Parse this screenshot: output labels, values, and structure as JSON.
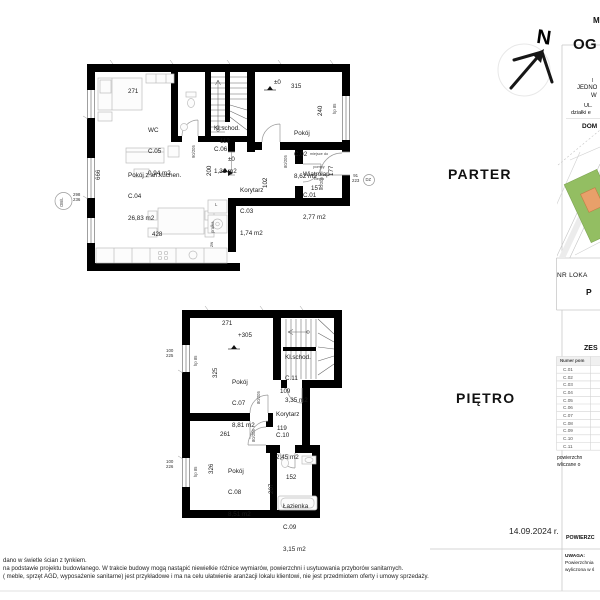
{
  "floors": {
    "parter_label": "PARTER",
    "pietro_label": "PIĘTRO"
  },
  "compass": {
    "north": "N"
  },
  "date": "14.09.2024 r.",
  "parter": {
    "rooms": [
      {
        "name": "WC",
        "id": "C.05",
        "area": "0,94 m2"
      },
      {
        "name": "Kl.schod.",
        "id": "C.06",
        "area": "1,31 m2"
      },
      {
        "name": "Pokój",
        "id": "C.02",
        "area": "8,62 m2"
      },
      {
        "name": "Pokój z an.kuchen.",
        "id": "C.04",
        "area": "26,83 m2"
      },
      {
        "name": "Korytarz",
        "id": "C.03",
        "area": "1,74 m2"
      },
      {
        "name": "Wiatrołap",
        "id": "C.01",
        "area": "2,77 m2"
      }
    ],
    "heat_pump_note": [
      "miejsce do",
      "pompy",
      "ciepła"
    ],
    "dims": {
      "w271": "271",
      "lvl_top": "±0",
      "w315": "315",
      "h240": "240",
      "hp85": "hp 85",
      "h666": "666",
      "w112": "112",
      "lvl_mid": "±0",
      "h200": "200",
      "h102": "102",
      "w157": "157",
      "h177": "177",
      "w428": "428",
      "door_stairs": "90/205",
      "door_c02": "80/205",
      "door_wiatrolap": "80/205",
      "entry_door": "91\n223",
      "entry_code": "DZ",
      "window_size": "298\n236",
      "window_code": "OB/L",
      "pralka": "pralka",
      "zw": "zw",
      "l_mark": "L"
    }
  },
  "pietro": {
    "rooms": [
      {
        "name": "Pokój",
        "id": "C.07",
        "area": "8,81 m2"
      },
      {
        "name": "Kl.schod.",
        "id": "C.11",
        "area": "3,35 m2"
      },
      {
        "name": "Korytarz",
        "id": "C.10",
        "area": "2,45 m2"
      },
      {
        "name": "Pokój",
        "id": "C.08",
        "area": "8,51 m2"
      },
      {
        "name": "Łazienka",
        "id": "C.09",
        "area": "3,15 m2"
      }
    ],
    "dims": {
      "w271": "271",
      "lvl": "+305",
      "h325": "325",
      "w109": "109",
      "w119": "119",
      "w261": "261",
      "h326": "326",
      "w152": "152",
      "h207": "207",
      "door_a": "80/205",
      "door_b": "80/205",
      "window_a": "100\n225",
      "window_b": "100\n226",
      "hp85_a": "hp 85",
      "hp85_b": "hp 85"
    }
  },
  "right_panel": {
    "top_fragment": "M",
    "logo_fragment": "OG",
    "subtitle_fragment_1": "I",
    "subtitle_fragment_2": "JEDNO",
    "subtitle_fragment_3": "W",
    "address_fragment_1": "UL.",
    "address_fragment_2": "działki e",
    "dom_fragment": "DOM",
    "nr_lokalu_fragment": "NR LOKA",
    "lokal_value_fragment": "P",
    "table_title_fragment": "ZES",
    "table_header_fragment": "Numer pom",
    "room_numbers": [
      "C.01",
      "C.02",
      "C.03",
      "C.04",
      "C.05",
      "C.06",
      "C.07",
      "C.08",
      "C.09",
      "C.10",
      "C.11"
    ],
    "footnote_fragment_1": "powierzchn",
    "footnote_fragment_2": "wliczane o",
    "bottom_header_fragment": "POWIERZC",
    "uwaga_title": "UWAGA:",
    "uwaga_line_1": "Powierzchnia",
    "uwaga_line_2": "wyliczona w ś",
    "map_colors": {
      "plot": "#93be62",
      "building": "#e8a06a",
      "roads": "#cfcfcf"
    }
  },
  "footer": {
    "line1": "dano w świetle ścian z tynkiem.",
    "line2": "na podstawie projektu budowlanego. W trakcie budowy mogą nastąpić niewielkie różnice wymiarów, powierzchni i usytuowania przyborów sanitarnych.",
    "line3": "( meble, sprzęt AGD, wyposażenie sanitarne) jest przykładowe i ma na celu ułatwienie aranżacji lokalu klientowi, nie jest przedmiotem oferty i umowy sprzedaży."
  }
}
